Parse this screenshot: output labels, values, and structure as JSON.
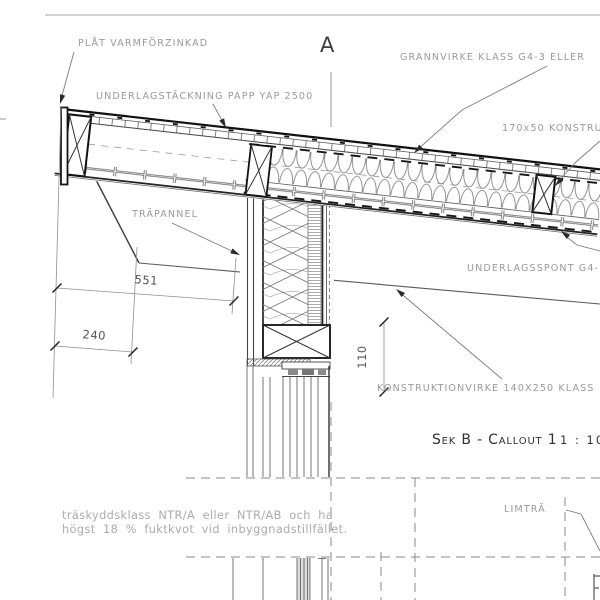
{
  "drawing": {
    "labels": {
      "plat": "PLÅT VARMFÖRZINKAD",
      "underlagstackning": "UNDERLAGSTÄCKNING PAPP YAP 2500",
      "grannvirke": "GRANNVIRKE KLASS G4-3 ELLER",
      "virke_170x50": "170x50 KONSTRU",
      "trapannel": "TRÄPANNEL",
      "underlagsspont": "UNDERLAGSSPONT G4-",
      "konstruktionvirke": "KONSTRUKTIONVIRKE 140X250 KLASS",
      "limtra": "LIMTRÄ"
    },
    "section_marker": "A",
    "dimensions": {
      "d551": "551",
      "d240": "240",
      "d110": "110"
    },
    "view_title": {
      "label": "Sek B - Callout 1",
      "scale": "1 : 10"
    },
    "notes": {
      "line1": "träskyddsklass NTR/A eller NTR/AB och ha",
      "line2": "högst 18 % fuktkvot vid inbyggnadstillfället."
    },
    "colors": {
      "background": "#ffffff",
      "cut_line": "#1a1a1a",
      "thin_line": "#5a5a5a",
      "label_text": "#9a9a9a",
      "note_text": "#ababab",
      "title_text": "#303030",
      "dim_text": "#555555"
    }
  }
}
